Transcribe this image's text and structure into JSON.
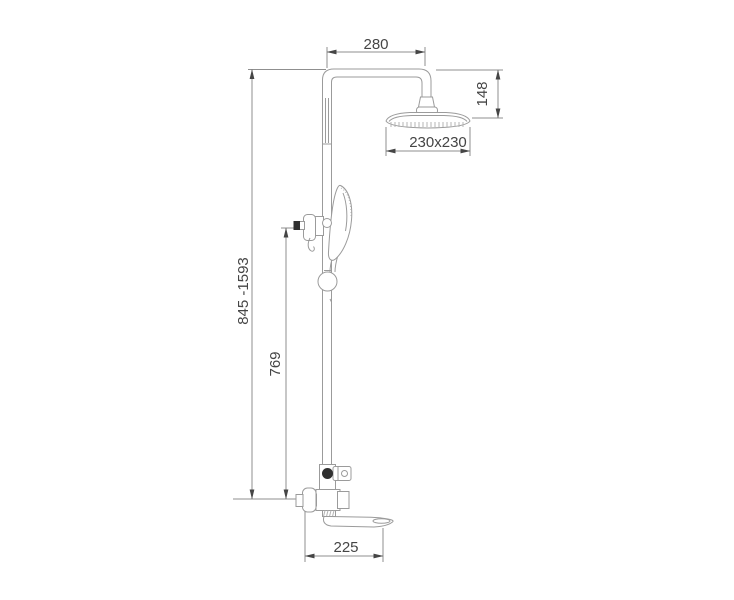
{
  "drawing": {
    "subject": "shower-column-technical-dimension-drawing",
    "colors": {
      "background": "#ffffff",
      "line": "#9b9b9b",
      "text": "#454545",
      "dark_fill": "#2f2f2f"
    },
    "dimensions": {
      "arm_width": {
        "label": "280",
        "orientation": "horizontal",
        "location": "top"
      },
      "head_offset": {
        "label": "148",
        "orientation": "vertical",
        "location": "top-right"
      },
      "head_size": {
        "label": "230x230",
        "orientation": "horizontal",
        "location": "below-shower-head"
      },
      "column_height": {
        "label": "845 -1593",
        "orientation": "vertical",
        "location": "left"
      },
      "rail_height": {
        "label": "769",
        "orientation": "vertical",
        "location": "inner-left"
      },
      "spout_length": {
        "label": "225",
        "orientation": "horizontal",
        "location": "bottom"
      }
    }
  }
}
